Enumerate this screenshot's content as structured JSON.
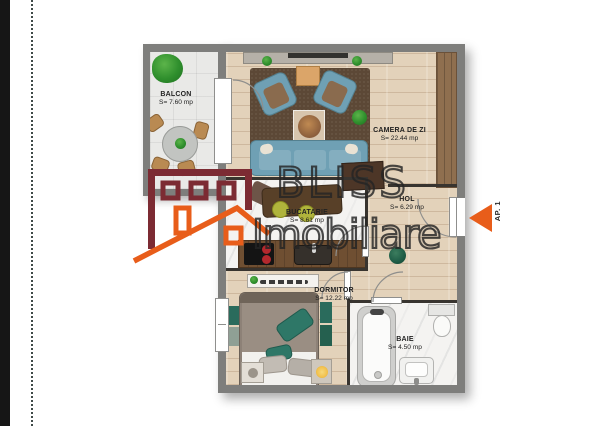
{
  "colors": {
    "wall": "#7e7e7c",
    "interior_wall": "#38342f",
    "orange": "#e85d1a",
    "maroon": "#7c2b33",
    "teal": "#6fa0b4",
    "rug": "#5c4836",
    "wood": "#e3d2ba",
    "marble": "#f4f3f1",
    "balcony_floor": "#e9e9e7",
    "counter": "#6f4f32",
    "pillow_teal": "#2e7767"
  },
  "rooms": [
    {
      "id": "balcon",
      "name": "BALCON",
      "area": "S= 7.60 mp"
    },
    {
      "id": "camera-de-zi",
      "name": "CAMERA DE ZI",
      "area": "S= 22.44 mp"
    },
    {
      "id": "hol",
      "name": "HOL",
      "area": "S= 6.29 mp"
    },
    {
      "id": "bucatarie",
      "name": "BUCATARIE",
      "area": "S= 8.61 mp"
    },
    {
      "id": "dormitor",
      "name": "DORMITOR",
      "area": "S= 12.22 mp"
    },
    {
      "id": "baie",
      "name": "BAIE",
      "area": "S= 4.50 mp"
    }
  ],
  "watermark": {
    "line1": "BLISS",
    "line2": "Imobiliare"
  },
  "entrance": {
    "label": "AP. 1"
  }
}
